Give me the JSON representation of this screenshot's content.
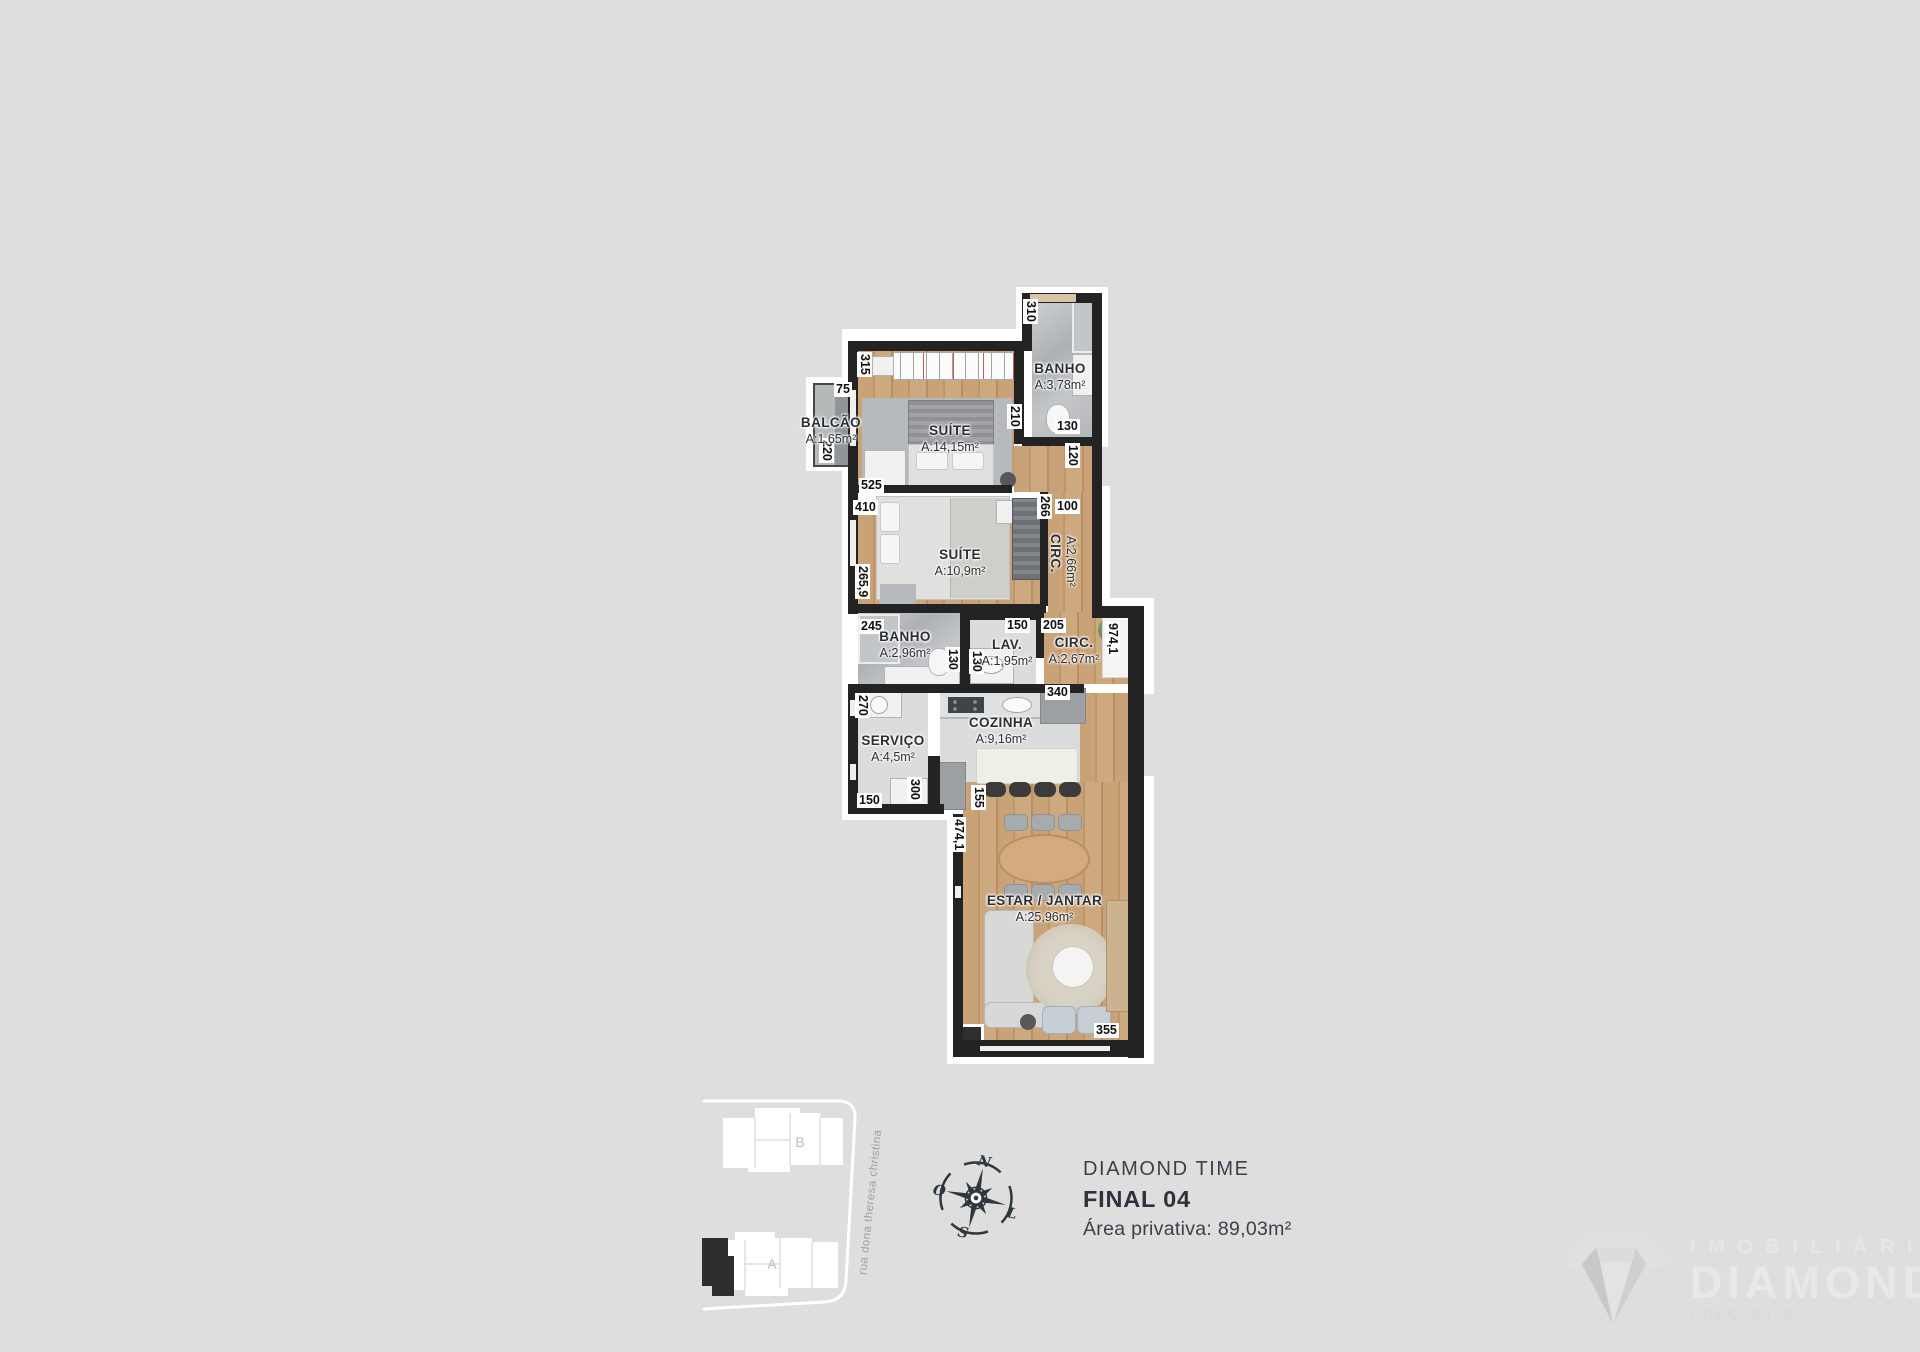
{
  "floorplan": {
    "rooms": [
      {
        "name": "BALCÃO",
        "area": "A:1,65m²",
        "x": 786,
        "y": 415,
        "w": 90
      },
      {
        "name": "SUÍTE",
        "area": "A:14,15m²",
        "x": 898,
        "y": 423,
        "w": 104
      },
      {
        "name": "BANHO",
        "area": "A:3,78m²",
        "x": 1018,
        "y": 361,
        "w": 84
      },
      {
        "name": "SUÍTE",
        "area": "A:10,9m²",
        "x": 908,
        "y": 547,
        "w": 104
      },
      {
        "name": "CIRC.",
        "area": "A:2,66m²",
        "x": 1048,
        "y": 534,
        "vertical": true
      },
      {
        "name": "BANHO",
        "area": "A:2,96m²",
        "x": 853,
        "y": 629,
        "w": 104
      },
      {
        "name": "LAV.",
        "area": "A:1,95m²",
        "x": 966,
        "y": 637,
        "w": 82
      },
      {
        "name": "CIRC.",
        "area": "A:2,67m²",
        "x": 1034,
        "y": 635,
        "w": 80
      },
      {
        "name": "SERVIÇO",
        "area": "A:4,5m²",
        "x": 843,
        "y": 733,
        "w": 100
      },
      {
        "name": "COZINHA",
        "area": "A:9,16m²",
        "x": 951,
        "y": 715,
        "w": 100
      },
      {
        "name": "ESTAR / JANTAR",
        "area": "A:25,96m²",
        "x": 974,
        "y": 893,
        "w": 141
      }
    ],
    "dimensions": [
      {
        "v": "315",
        "x": 857,
        "y": 352,
        "o": "v"
      },
      {
        "v": "75",
        "x": 834,
        "y": 382,
        "o": "h"
      },
      {
        "v": "220",
        "x": 819,
        "y": 438,
        "o": "v"
      },
      {
        "v": "525",
        "x": 859,
        "y": 478,
        "o": "h"
      },
      {
        "v": "410",
        "x": 853,
        "y": 500,
        "o": "h"
      },
      {
        "v": "265,9",
        "x": 855,
        "y": 564,
        "o": "v"
      },
      {
        "v": "310",
        "x": 1023,
        "y": 299,
        "o": "v"
      },
      {
        "v": "210",
        "x": 1007,
        "y": 404,
        "o": "v"
      },
      {
        "v": "130",
        "x": 1055,
        "y": 419,
        "o": "h"
      },
      {
        "v": "120",
        "x": 1065,
        "y": 443,
        "o": "v"
      },
      {
        "v": "266",
        "x": 1037,
        "y": 494,
        "o": "v"
      },
      {
        "v": "100",
        "x": 1055,
        "y": 499,
        "o": "h"
      },
      {
        "v": "245",
        "x": 859,
        "y": 619,
        "o": "h"
      },
      {
        "v": "130",
        "x": 945,
        "y": 647,
        "o": "v"
      },
      {
        "v": "150",
        "x": 1005,
        "y": 618,
        "o": "h"
      },
      {
        "v": "130",
        "x": 969,
        "y": 649,
        "o": "v"
      },
      {
        "v": "205",
        "x": 1041,
        "y": 618,
        "o": "h"
      },
      {
        "v": "974,1",
        "x": 1105,
        "y": 621,
        "o": "v"
      },
      {
        "v": "270",
        "x": 855,
        "y": 693,
        "o": "v"
      },
      {
        "v": "340",
        "x": 1045,
        "y": 685,
        "o": "h"
      },
      {
        "v": "150",
        "x": 857,
        "y": 793,
        "o": "h"
      },
      {
        "v": "300",
        "x": 907,
        "y": 777,
        "o": "v"
      },
      {
        "v": "155",
        "x": 971,
        "y": 785,
        "o": "v"
      },
      {
        "v": "474,1",
        "x": 951,
        "y": 817,
        "o": "v"
      },
      {
        "v": "355",
        "x": 1094,
        "y": 1023,
        "o": "h"
      }
    ]
  },
  "siteplan": {
    "building_b": "B",
    "building_a": "A",
    "street": "rua dona theresa christina"
  },
  "compass": {
    "north": "N",
    "south": "S",
    "east": "L",
    "west": "O"
  },
  "info": {
    "project": "DIAMOND TIME",
    "unit": "FINAL 04",
    "area": "Área privativa: 89,03m²"
  },
  "watermark": {
    "line1": "IMOBILIÁRIA",
    "line2": "DIAMOND",
    "line3": "CRECI 5435J"
  },
  "colors": {
    "background": "#dedede",
    "wall": "#232323",
    "wood_floor": "#c49b6f",
    "ink": "#2c333c"
  }
}
